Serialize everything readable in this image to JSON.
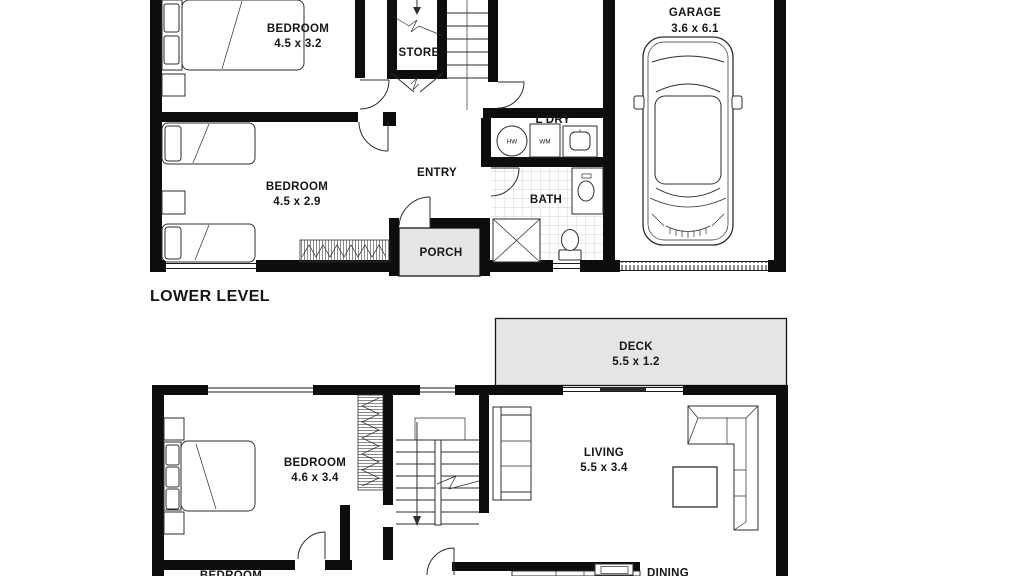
{
  "floorplan": {
    "level_label": "LOWER LEVEL",
    "colors": {
      "wall": "#0d0d0d",
      "line": "#2e2e2e",
      "area_fill": "#e5e5e5",
      "tile_line": "#c2c2c2",
      "text": "#161616",
      "background": "#ffffff"
    },
    "upper_level": {
      "rooms": [
        {
          "name": "BEDROOM",
          "dims": "4.5 x 3.2"
        },
        {
          "name": "BEDROOM",
          "dims": "4.5 x 2.9"
        },
        {
          "name": "STORE",
          "dims": ""
        },
        {
          "name": "ENTRY",
          "dims": ""
        },
        {
          "name": "L'DRY",
          "dims": ""
        },
        {
          "name": "BATH",
          "dims": ""
        },
        {
          "name": "PORCH",
          "dims": ""
        },
        {
          "name": "GARAGE",
          "dims": "3.6 x 6.1"
        }
      ],
      "appliance_labels": {
        "hot_water": "HW",
        "washing_machine": "WM"
      }
    },
    "lower_level": {
      "rooms": [
        {
          "name": "DECK",
          "dims": "5.5 x 1.2"
        },
        {
          "name": "BEDROOM",
          "dims": "4.6 x 3.4"
        },
        {
          "name": "LIVING",
          "dims": "5.5 x 3.4"
        },
        {
          "name": "BEDROOM",
          "dims": ""
        },
        {
          "name": "DINING",
          "dims": ""
        }
      ]
    }
  }
}
